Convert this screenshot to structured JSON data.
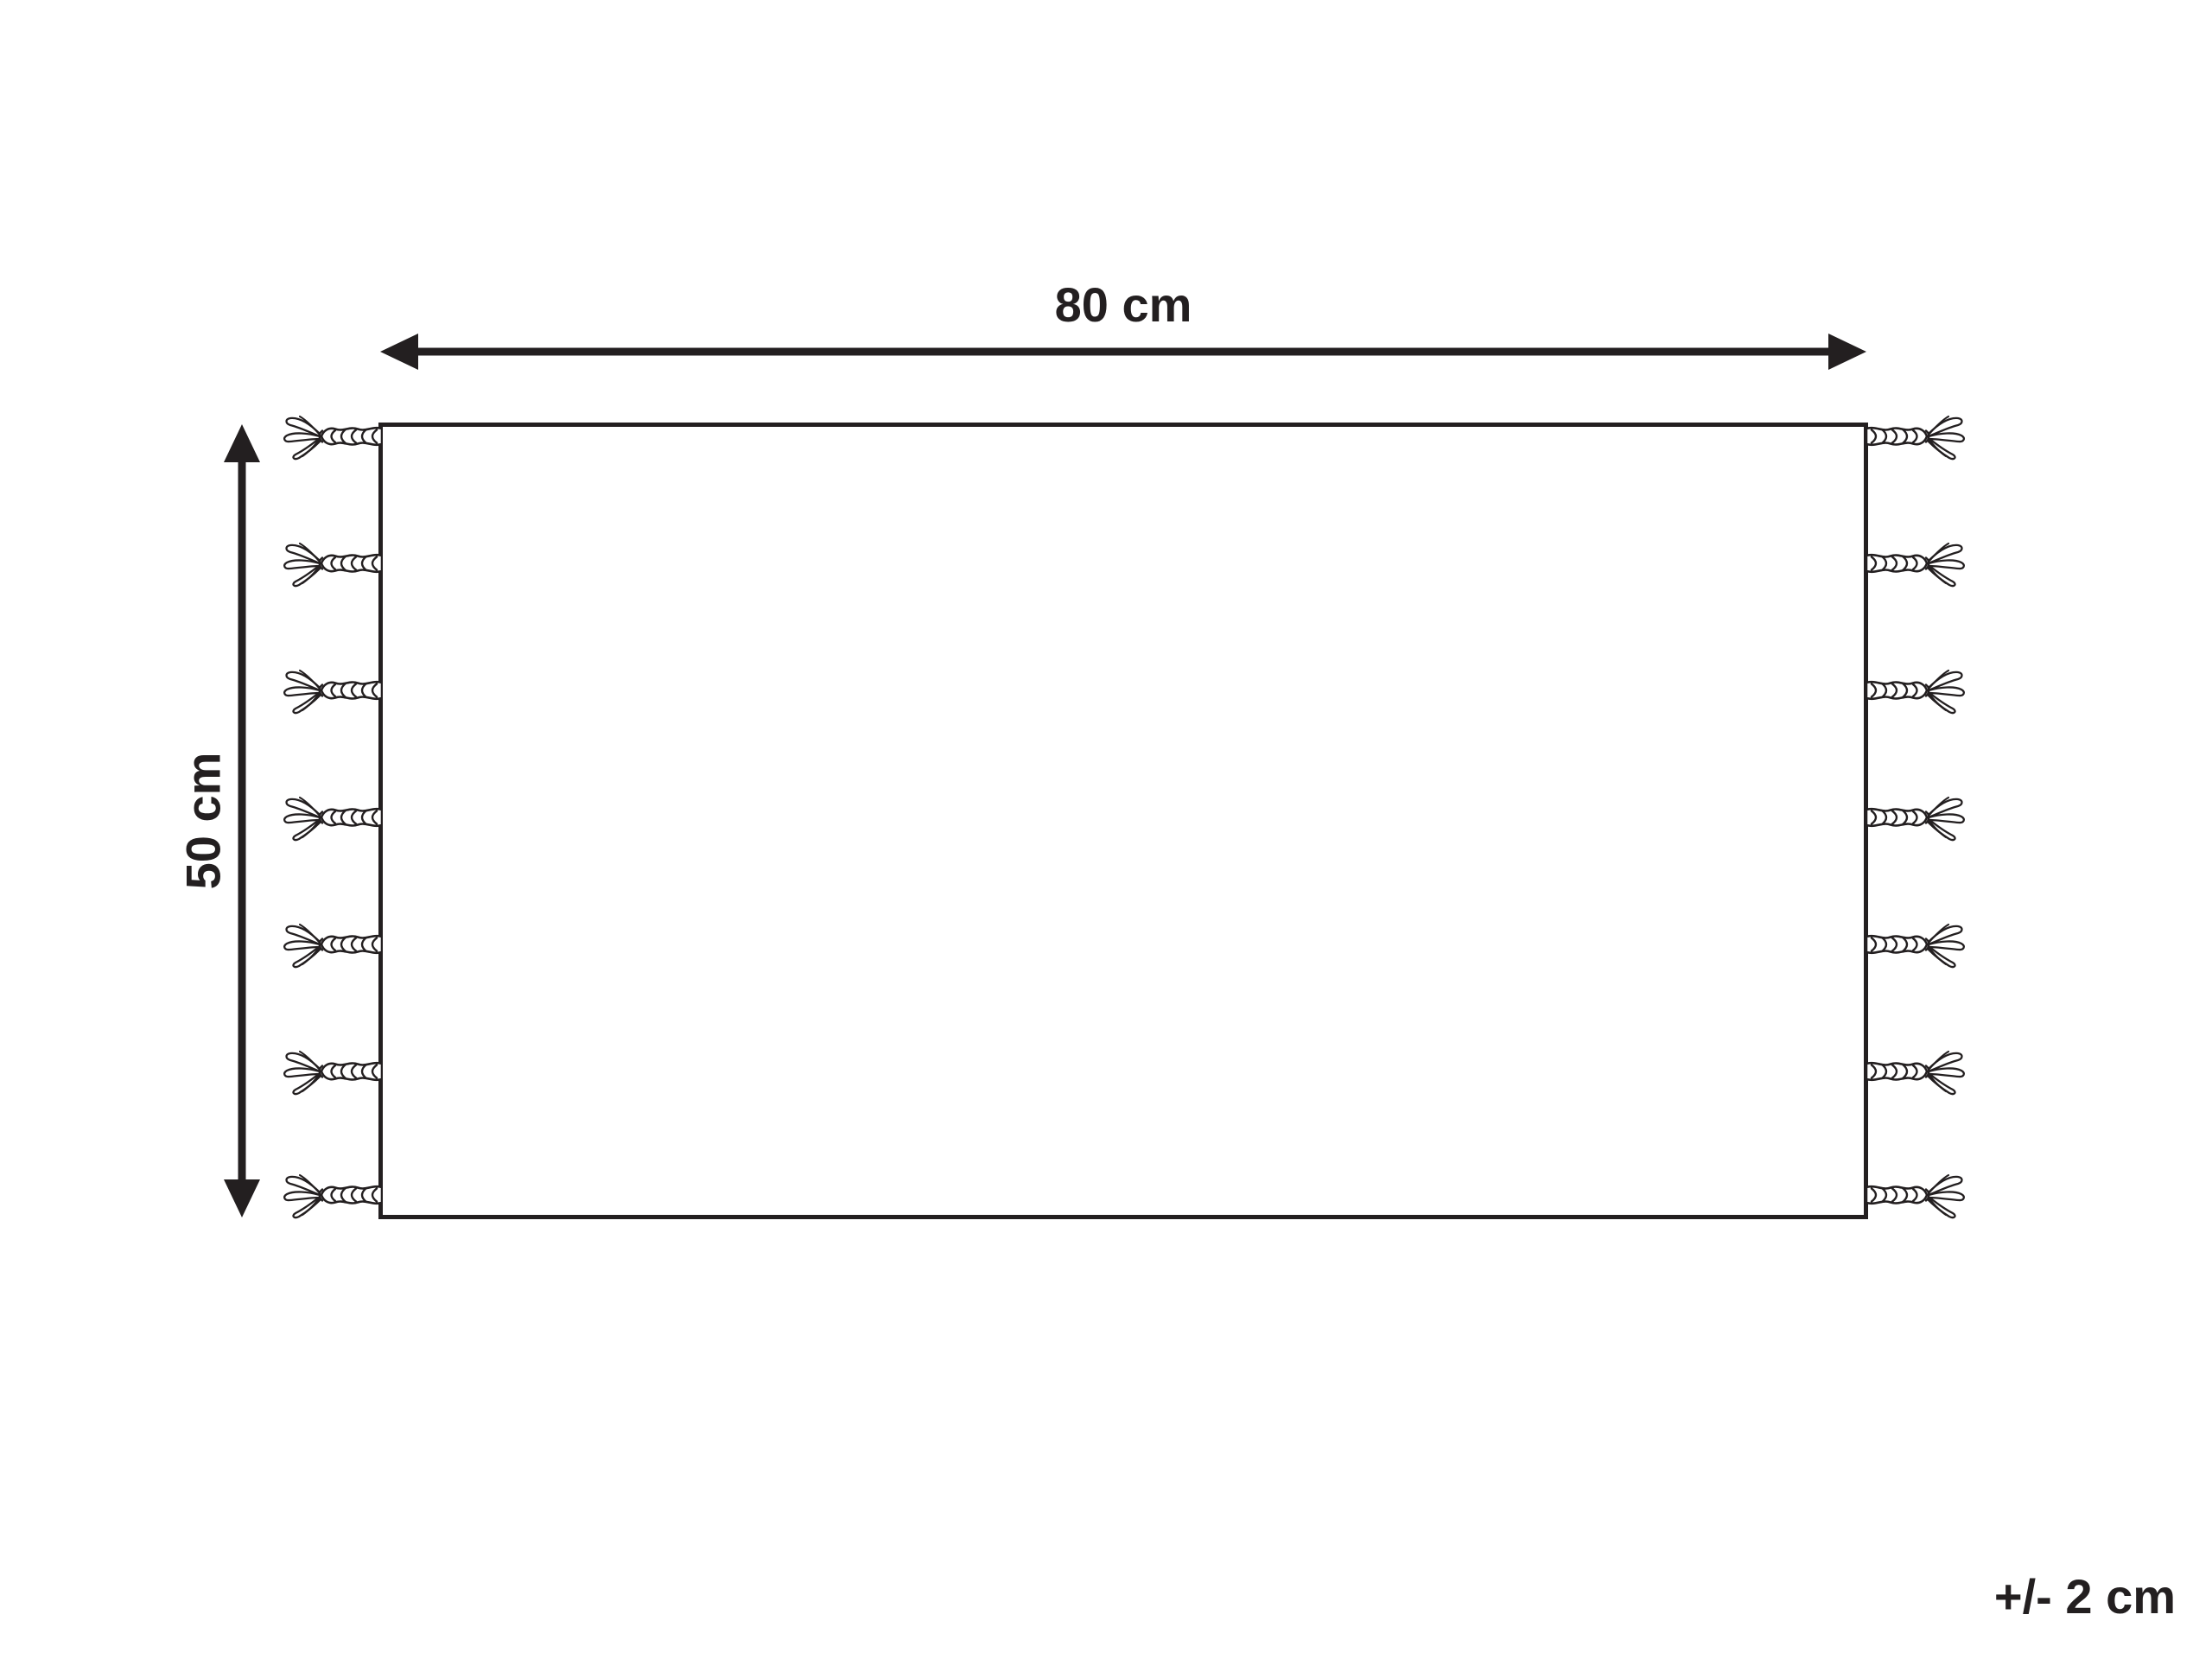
{
  "diagram": {
    "type": "product-dimension-diagram",
    "subject": "rug-with-tassels",
    "width_label": "80 cm",
    "height_label": "50 cm",
    "tolerance_label": "+/- 2 cm",
    "tassels_per_side": 7,
    "colors": {
      "line": "#231f20",
      "background": "#ffffff"
    }
  }
}
